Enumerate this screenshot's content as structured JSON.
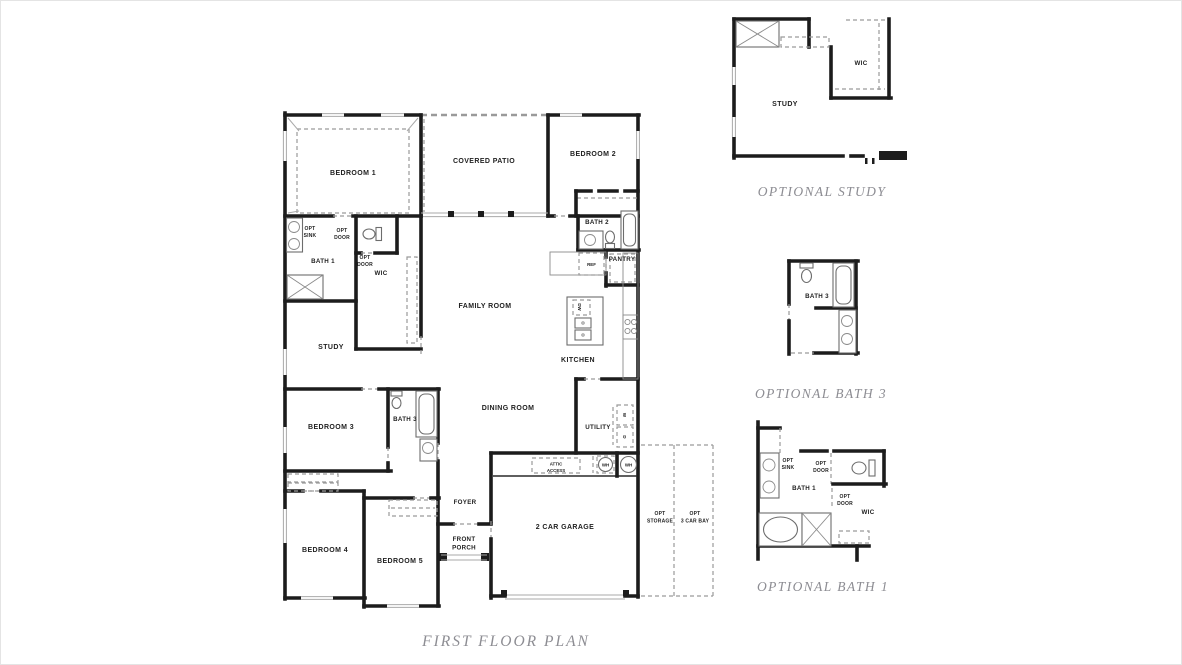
{
  "title": "FIRST FLOOR PLAN",
  "colors": {
    "wall": "#1c1c1c",
    "dashed": "#9a9a9a",
    "label": "#222222",
    "caption": "#8d8d93"
  },
  "main_plan": {
    "rooms": {
      "bedroom_1": "BEDROOM 1",
      "covered_patio": "COVERED PATIO",
      "bedroom_2": "BEDROOM 2",
      "bath_2": "BATH 2",
      "pantry": "PANTRY",
      "bath_1": "BATH 1",
      "wic": "WIC",
      "study": "STUDY",
      "family_room": "FAMILY ROOM",
      "kitchen": "KITCHEN",
      "dining_room": "DINING ROOM",
      "utility": "UTILITY",
      "bedroom_3": "BEDROOM 3",
      "bath_3": "BATH 3",
      "bedroom_4": "BEDROOM 4",
      "bedroom_5": "BEDROOM 5",
      "foyer": "FOYER",
      "front_porch": {
        "line1": "FRONT",
        "line2": "PORCH"
      },
      "garage": "2 CAR GARAGE",
      "opt_storage": {
        "line1": "OPT",
        "line2": "STORAGE"
      },
      "opt_3_car_bay": {
        "line1": "OPT",
        "line2": "3 CAR BAY"
      }
    },
    "annotations": {
      "opt": "OPT",
      "sink": "SINK",
      "door": "DOOR",
      "attic": "ATTIC",
      "access": "ACCESS",
      "ref": "REF",
      "dw": "DW",
      "washer": "W",
      "dryer": "D",
      "wh": "WH"
    }
  },
  "optional_study": {
    "caption": "OPTIONAL STUDY",
    "rooms": {
      "study": "STUDY",
      "wic": "WIC"
    }
  },
  "optional_bath_3": {
    "caption": "OPTIONAL BATH 3",
    "rooms": {
      "bath_3": "BATH 3"
    }
  },
  "optional_bath_1": {
    "caption": "OPTIONAL BATH 1",
    "rooms": {
      "bath_1": "BATH 1",
      "wic": "WIC"
    },
    "annotations": {
      "opt": "OPT",
      "sink": "SINK",
      "door": "DOOR"
    }
  }
}
